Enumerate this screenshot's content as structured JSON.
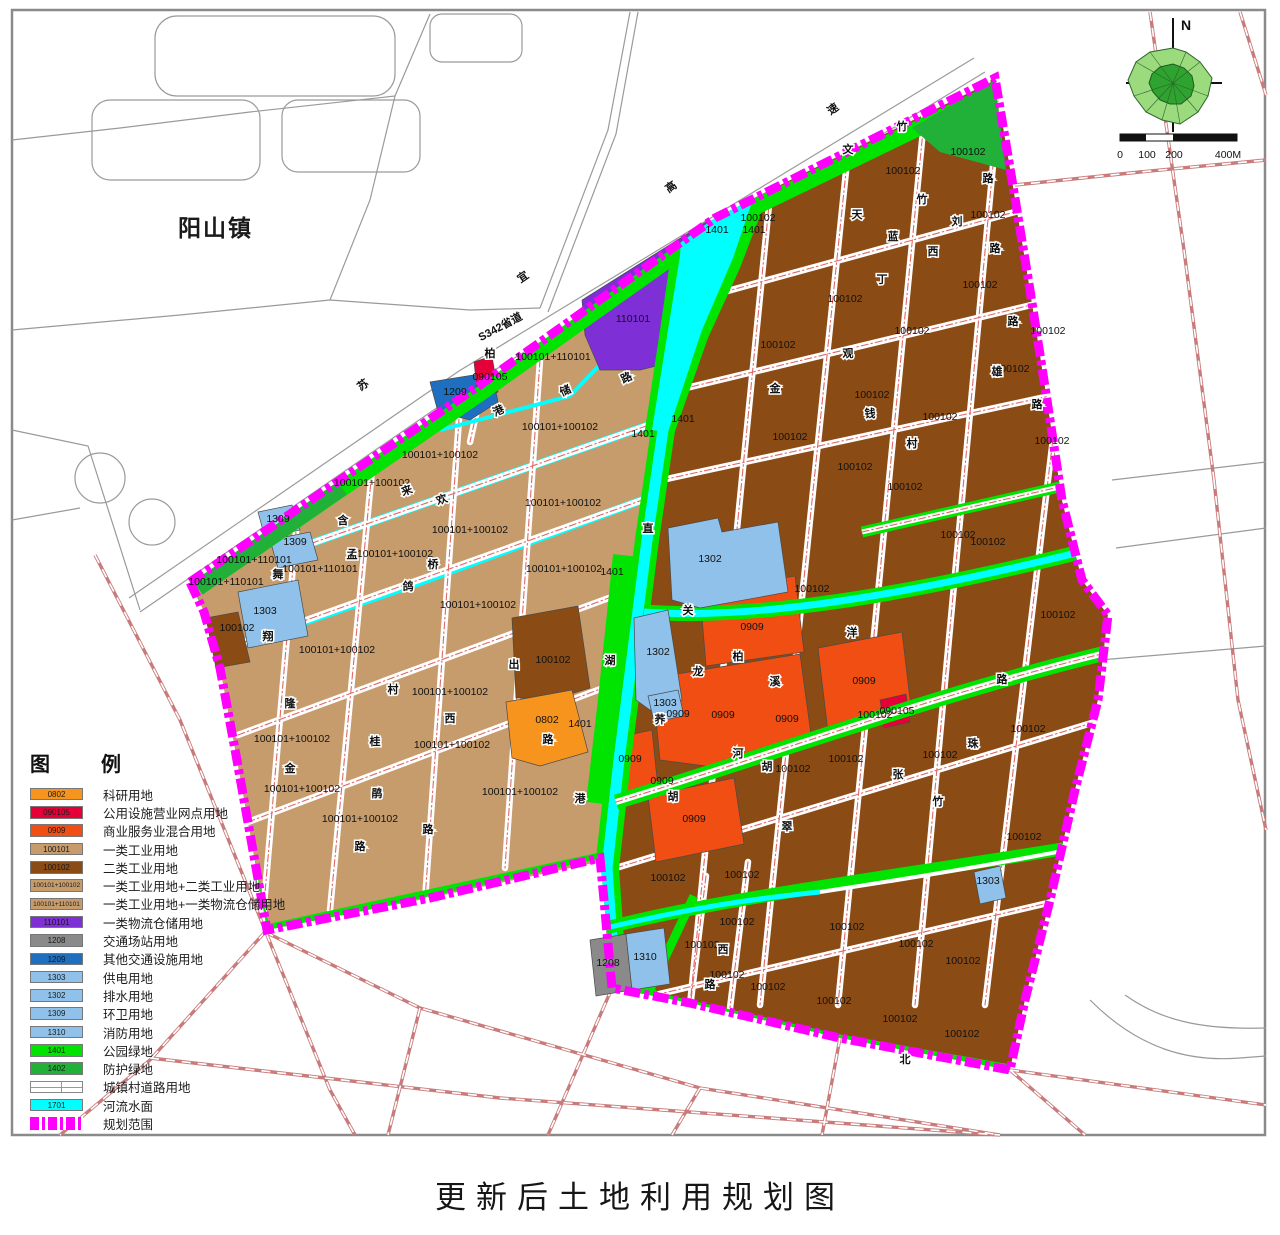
{
  "page": {
    "title": "更新后土地利用规划图"
  },
  "map": {
    "town_label": "阳山镇",
    "north_label": "N",
    "scale": {
      "t0": "0",
      "t1": "100",
      "t2": "200",
      "t3": "400M"
    }
  },
  "palette": {
    "k0802": "#F7941E",
    "k090105": "#E5003A",
    "k0909": "#F04E12",
    "k100101": "#C69C6D",
    "k100102": "#8A4B15",
    "mix12": "#C69C6D",
    "mix11": "#C69C6D",
    "k110101": "#7E2FD6",
    "k1208": "#8A8A8A",
    "k1209": "#1E6FC0",
    "k1303": "#8FC1EA",
    "k1302": "#8FC1EA",
    "k1309": "#8FC1EA",
    "k1310": "#8FC1EA",
    "k1401": "#00E400",
    "k1402": "#21B038",
    "road": "#FFFFFF",
    "k1701": "#00FFFF",
    "boundary": "#FF00FF"
  },
  "legend": {
    "header_l": "图",
    "header_r": "例",
    "items": [
      {
        "code": "0802",
        "label": "科研用地",
        "pal": "k0802",
        "kind": "swatch"
      },
      {
        "code": "090105",
        "label": "公用设施营业网点用地",
        "pal": "k090105",
        "kind": "swatch"
      },
      {
        "code": "0909",
        "label": "商业服务业混合用地",
        "pal": "k0909",
        "kind": "swatch"
      },
      {
        "code": "100101",
        "label": "一类工业用地",
        "pal": "k100101",
        "kind": "swatch"
      },
      {
        "code": "100102",
        "label": "二类工业用地",
        "pal": "k100102",
        "kind": "swatch"
      },
      {
        "code": "100101+100102",
        "label": "一类工业用地+二类工业用地",
        "pal": "mix12",
        "kind": "swatch"
      },
      {
        "code": "100101+110101",
        "label": "一类工业用地+一类物流仓储用地",
        "pal": "mix11",
        "kind": "swatch"
      },
      {
        "code": "110101",
        "label": "一类物流仓储用地",
        "pal": "k110101",
        "kind": "swatch"
      },
      {
        "code": "1208",
        "label": "交通场站用地",
        "pal": "k1208",
        "kind": "swatch"
      },
      {
        "code": "1209",
        "label": "其他交通设施用地",
        "pal": "k1209",
        "kind": "swatch"
      },
      {
        "code": "1303",
        "label": "供电用地",
        "pal": "k1303",
        "kind": "swatch"
      },
      {
        "code": "1302",
        "label": "排水用地",
        "pal": "k1302",
        "kind": "swatch"
      },
      {
        "code": "1309",
        "label": "环卫用地",
        "pal": "k1309",
        "kind": "swatch"
      },
      {
        "code": "1310",
        "label": "消防用地",
        "pal": "k1310",
        "kind": "swatch"
      },
      {
        "code": "1401",
        "label": "公园绿地",
        "pal": "k1401",
        "kind": "swatch"
      },
      {
        "code": "1402",
        "label": "防护绿地",
        "pal": "k1402",
        "kind": "swatch"
      },
      {
        "code": "",
        "label": "城镇村道路用地",
        "pal": "road",
        "kind": "road"
      },
      {
        "code": "1701",
        "label": "河流水面",
        "pal": "k1701",
        "kind": "swatch"
      },
      {
        "code": "",
        "label": "规划范围",
        "pal": "boundary",
        "kind": "boundary"
      }
    ]
  },
  "labels": {
    "parcels": [
      [
        "100102",
        903,
        174
      ],
      [
        "100102",
        968,
        155
      ],
      [
        "100102",
        758,
        221
      ],
      [
        "100102",
        988,
        218
      ],
      [
        "100102",
        845,
        302
      ],
      [
        "100102",
        980,
        288
      ],
      [
        "100102",
        912,
        334
      ],
      [
        "100102",
        1048,
        334
      ],
      [
        "100102",
        778,
        348
      ],
      [
        "100102",
        1012,
        372
      ],
      [
        "100102",
        872,
        398
      ],
      [
        "100102",
        940,
        420
      ],
      [
        "100102",
        1052,
        444
      ],
      [
        "100102",
        790,
        440
      ],
      [
        "100102",
        855,
        470
      ],
      [
        "100102",
        905,
        490
      ],
      [
        "100102",
        958,
        538
      ],
      [
        "100102",
        988,
        545
      ],
      [
        "100102",
        1058,
        618
      ],
      [
        "100102",
        812,
        592
      ],
      [
        "100102",
        875,
        718
      ],
      [
        "100102",
        940,
        758
      ],
      [
        "100102",
        1028,
        732
      ],
      [
        "100102",
        793,
        772
      ],
      [
        "100102",
        846,
        762
      ],
      [
        "100102",
        1024,
        840
      ],
      [
        "100102",
        668,
        881
      ],
      [
        "100102",
        742,
        878
      ],
      [
        "100102",
        737,
        925
      ],
      [
        "100102",
        847,
        930
      ],
      [
        "100102",
        702,
        948
      ],
      [
        "100102",
        727,
        978
      ],
      [
        "100102",
        768,
        990
      ],
      [
        "100102",
        834,
        1004
      ],
      [
        "100102",
        900,
        1022
      ],
      [
        "100102",
        962,
        1037
      ],
      [
        "100102",
        916,
        947
      ],
      [
        "100102",
        963,
        964
      ],
      [
        "100101+100102",
        560,
        430
      ],
      [
        "100101+100102",
        440,
        458
      ],
      [
        "100101+100102",
        372,
        486
      ],
      [
        "100101+100102",
        563,
        506
      ],
      [
        "100101+100102",
        470,
        533
      ],
      [
        "100101+100102",
        395,
        557
      ],
      [
        "100101+100102",
        564,
        572
      ],
      [
        "100101+100102",
        478,
        608
      ],
      [
        "100101+100102",
        337,
        653
      ],
      [
        "100101+100102",
        450,
        695
      ],
      [
        "100101+100102",
        292,
        742
      ],
      [
        "100101+100102",
        452,
        748
      ],
      [
        "100101+100102",
        302,
        792
      ],
      [
        "100101+100102",
        360,
        822
      ],
      [
        "100101+100102",
        520,
        795
      ],
      [
        "100101+110101",
        553,
        360
      ],
      [
        "100101+110101",
        254,
        563
      ],
      [
        "100101+110101",
        320,
        572
      ],
      [
        "100101+110101",
        226,
        585
      ],
      [
        "110101",
        633,
        322,
        12
      ],
      [
        "0909",
        752,
        630,
        12
      ],
      [
        "0909",
        864,
        684,
        12
      ],
      [
        "0909",
        678,
        717,
        12
      ],
      [
        "0909",
        723,
        718,
        12
      ],
      [
        "0909",
        787,
        722,
        12
      ],
      [
        "0909",
        630,
        762,
        11
      ],
      [
        "0909",
        662,
        784,
        11
      ],
      [
        "0909",
        694,
        822,
        12
      ],
      [
        "090105",
        490,
        380
      ],
      [
        "090105",
        897,
        714
      ],
      [
        "0802",
        547,
        723,
        12
      ],
      [
        "1208",
        608,
        966
      ],
      [
        "1310",
        645,
        960
      ],
      [
        "1209",
        455,
        395
      ],
      [
        "1302",
        710,
        562,
        12
      ],
      [
        "1302",
        658,
        655
      ],
      [
        "1303",
        265,
        614,
        12
      ],
      [
        "1303",
        665,
        706
      ],
      [
        "1303",
        988,
        884
      ],
      [
        "1309",
        278,
        522
      ],
      [
        "1309",
        295,
        545
      ],
      [
        "1401",
        717,
        233,
        12
      ],
      [
        "1401",
        754,
        233,
        12
      ],
      [
        "1401",
        643,
        437
      ],
      [
        "1401",
        683,
        422
      ],
      [
        "1401",
        612,
        575
      ],
      [
        "1401",
        580,
        727
      ],
      [
        "100102",
        237,
        631
      ],
      [
        "100102",
        553,
        663
      ]
    ],
    "roads": [
      [
        "苏",
        365,
        388,
        -35
      ],
      [
        "宜",
        525,
        280,
        -35
      ],
      [
        "高",
        673,
        190,
        -35
      ],
      [
        "速",
        835,
        112,
        -35
      ],
      [
        "S342省道",
        502,
        330,
        -28,
        9
      ],
      [
        "柏",
        490,
        357
      ],
      [
        "港",
        500,
        414,
        -25
      ],
      [
        "储",
        567,
        394,
        -25
      ],
      [
        "路",
        628,
        381,
        -25
      ],
      [
        "来",
        408,
        494,
        -20
      ],
      [
        "欢",
        443,
        503,
        -20
      ],
      [
        "含",
        343,
        524
      ],
      [
        "孟",
        352,
        558
      ],
      [
        "桥",
        433,
        568
      ],
      [
        "鸽",
        408,
        590
      ],
      [
        "舞",
        278,
        578
      ],
      [
        "翔",
        268,
        640
      ],
      [
        "隆",
        290,
        707
      ],
      [
        "金",
        290,
        772
      ],
      [
        "桂",
        375,
        745
      ],
      [
        "鹃",
        377,
        797
      ],
      [
        "路",
        360,
        850
      ],
      [
        "村",
        393,
        693
      ],
      [
        "西",
        450,
        722
      ],
      [
        "路",
        428,
        833
      ],
      [
        "出",
        514,
        668
      ],
      [
        "路",
        548,
        743
      ],
      [
        "直",
        648,
        532
      ],
      [
        "湖",
        610,
        664
      ],
      [
        "港",
        580,
        802
      ],
      [
        "关",
        688,
        614
      ],
      [
        "龙",
        698,
        675
      ],
      [
        "荞",
        660,
        723
      ],
      [
        "柏",
        738,
        660
      ],
      [
        "溪",
        775,
        685
      ],
      [
        "河",
        738,
        757
      ],
      [
        "胡",
        767,
        770
      ],
      [
        "洋",
        852,
        636
      ],
      [
        "路",
        1002,
        683
      ],
      [
        "珠",
        973,
        747
      ],
      [
        "张",
        898,
        778
      ],
      [
        "竹",
        938,
        805
      ],
      [
        "竹",
        902,
        130
      ],
      [
        "文",
        848,
        153
      ],
      [
        "天",
        857,
        218
      ],
      [
        "竹",
        922,
        203
      ],
      [
        "刘",
        957,
        225
      ],
      [
        "蓝",
        893,
        240
      ],
      [
        "丁",
        882,
        283
      ],
      [
        "西",
        933,
        255
      ],
      [
        "路",
        988,
        182
      ],
      [
        "路",
        995,
        252
      ],
      [
        "观",
        848,
        357
      ],
      [
        "路",
        1013,
        325
      ],
      [
        "雄",
        997,
        375
      ],
      [
        "路",
        1037,
        408
      ],
      [
        "村",
        912,
        447
      ],
      [
        "钱",
        870,
        417
      ],
      [
        "金",
        775,
        392
      ],
      [
        "翠",
        787,
        830
      ],
      [
        "胡",
        673,
        800
      ],
      [
        "北",
        905,
        1063
      ],
      [
        "西",
        723,
        953
      ],
      [
        "路",
        710,
        988
      ]
    ]
  }
}
